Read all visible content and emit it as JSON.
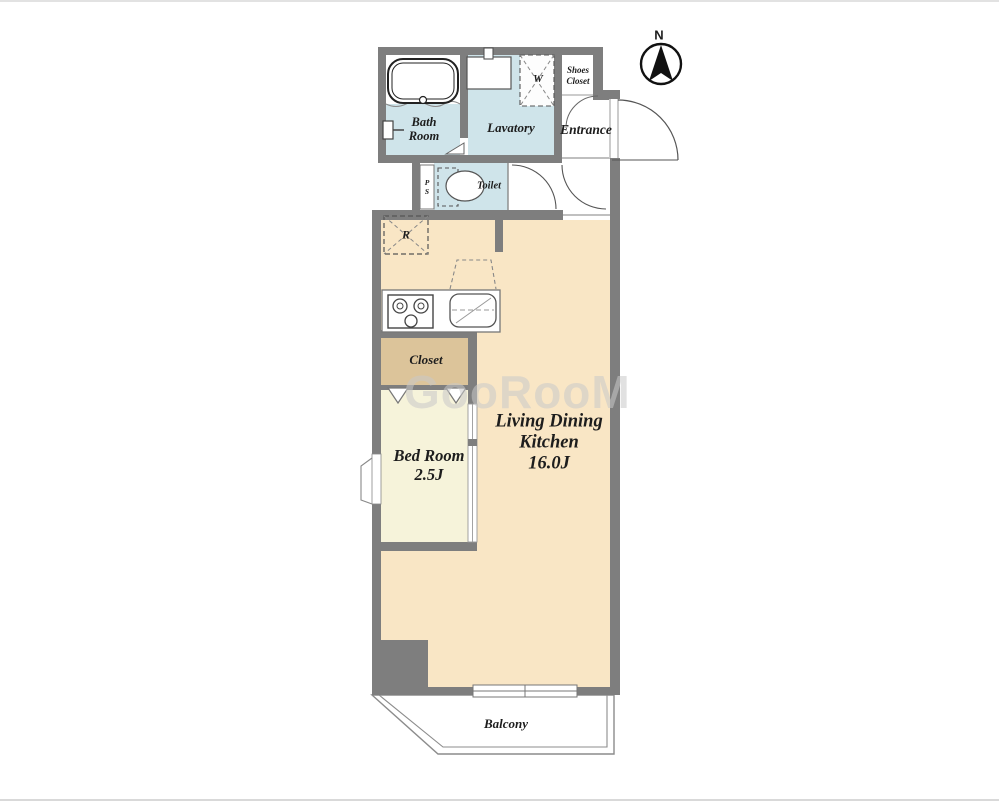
{
  "compass": {
    "label": "N"
  },
  "watermark": {
    "text": "GooRooM"
  },
  "labels": {
    "bath_line1": "Bath",
    "bath_line2": "Room",
    "lavatory": "Lavatory",
    "shoes_line1": "Shoes",
    "shoes_line2": "Closet",
    "entrance": "Entrance",
    "toilet": "Toilet",
    "ps_line1": "P",
    "ps_line2": "S",
    "refrigerator": "R",
    "washer": "W",
    "closet": "Closet",
    "bedroom_name": "Bed Room",
    "bedroom_size": "2.5J",
    "ldk_line1": "Living Dining",
    "ldk_line2": "Kitchen",
    "ldk_size": "16.0J",
    "balcony": "Balcony"
  },
  "colors": {
    "wall": "#7e7e7e",
    "ldk_floor": "#f9e6c5",
    "bedroom_floor": "#f6f3da",
    "closet_floor": "#dcc49a",
    "wet_area_floor": "#cfe4ea",
    "balcony_floor": "#ffffff",
    "line": "#707070",
    "text": "#1d1d1d",
    "watermark": "#c9c9c9"
  }
}
